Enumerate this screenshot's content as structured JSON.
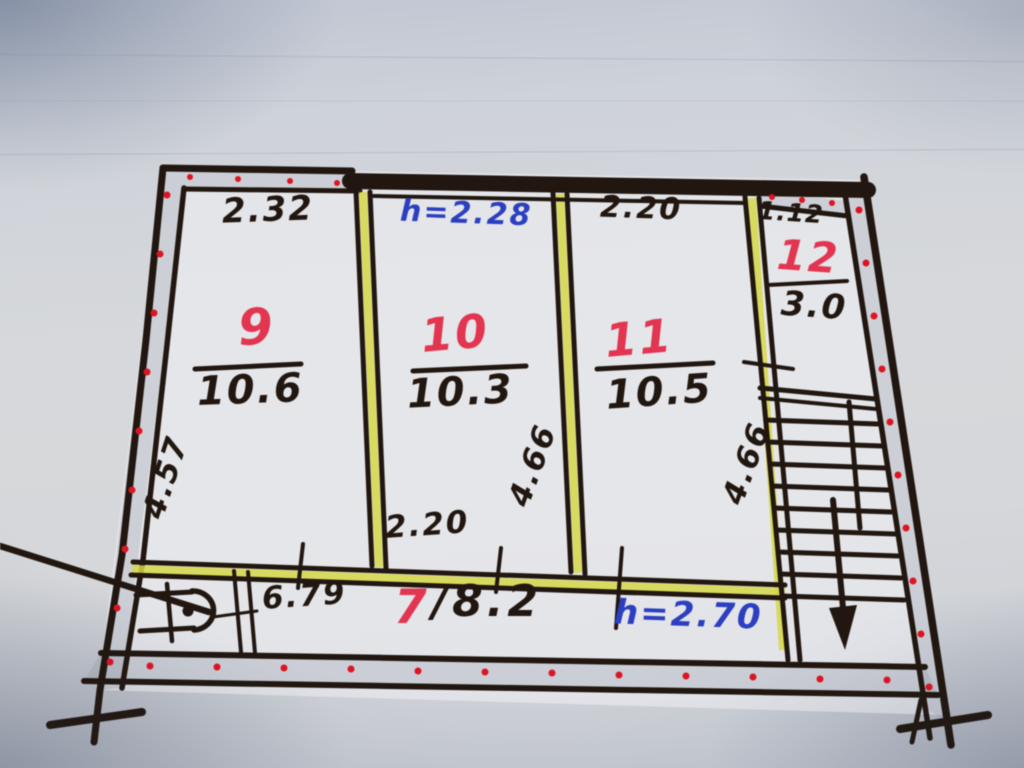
{
  "plan": {
    "rooms": {
      "room9": {
        "number": "9",
        "area": "10.6",
        "dim_width": "2.32",
        "dim_depth": "4.57"
      },
      "room10": {
        "number": "10",
        "area": "10.3",
        "dim_ceiling": "h=2.28",
        "dim_depth": "4.66",
        "dim_width": "2.20"
      },
      "room11": {
        "number": "11",
        "area": "10.5",
        "dim_width": "2.20",
        "dim_depth": "4.66"
      },
      "room12": {
        "number": "12",
        "area": "3.0",
        "dim_width": "1.12"
      },
      "corridor7": {
        "number": "7",
        "area_with_slash": "/8.2",
        "dim_length": "6.79",
        "dim_ceiling": "h=2.70"
      }
    },
    "colors": {
      "ink": "#211710",
      "red_ink": "#e23550",
      "blue_ink": "#2b3fc0",
      "highlighter": "#d6d747",
      "hatch_dot_red": "#dd1422",
      "paper": "#d3d5da"
    }
  }
}
